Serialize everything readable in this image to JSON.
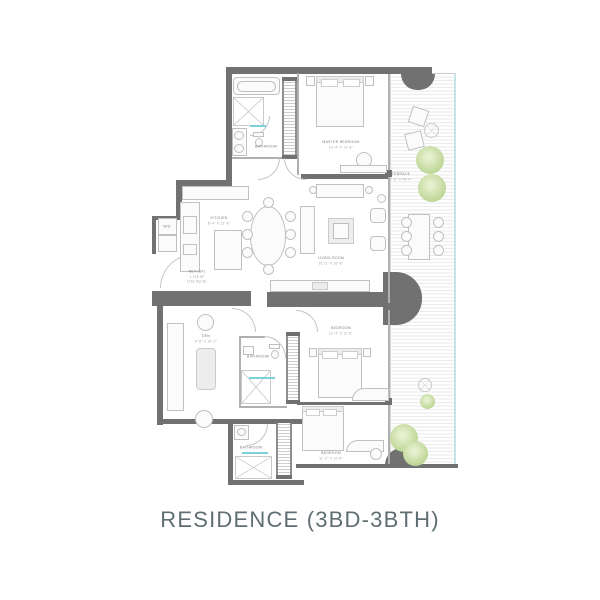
{
  "title": "RESIDENCE (3BD-3BTH)",
  "rooms": {
    "master_bedroom": {
      "name": "MASTER BEDROOM",
      "dims": "13'-4\" X 13'-8\""
    },
    "master_bathroom": {
      "name": "BATHROOM"
    },
    "kitchen": {
      "name": "KITCHEN",
      "dims": "8'-4\" X 12'-6\""
    },
    "living_room": {
      "name": "LIVING ROOM",
      "dims": "21'-2\" X 16'-8\""
    },
    "terrace": {
      "name": "TERRACE",
      "dims": "7'-6\" X 43'-4\""
    },
    "den": {
      "name": "DEN",
      "dims": "9'-8\" X 13'-2\""
    },
    "bedroom_2": {
      "name": "BEDROOM",
      "dims": "12'-4\" X 11'-6\""
    },
    "bathroom_2": {
      "name": "BATHROOM"
    },
    "bedroom_3": {
      "name": "BEDROOM",
      "dims": "11'-2\" X 11'-8\""
    },
    "bathroom_3": {
      "name": "BATHROOM"
    },
    "laundry": {
      "name": "W/D"
    }
  },
  "annotations": {
    "net_area": {
      "line1": "NET (SF)",
      "line2": "1,745 SF",
      "line3": "(162 SQ M)"
    }
  },
  "colors": {
    "wall": "#717171",
    "thin_wall": "#b0b0b0",
    "accent_aqua": "#7bd2da",
    "plant_green": "#c8dda4",
    "glass_teal": "#c5e4e6",
    "label_text": "#8a9494",
    "title_text": "#5e6e71"
  }
}
